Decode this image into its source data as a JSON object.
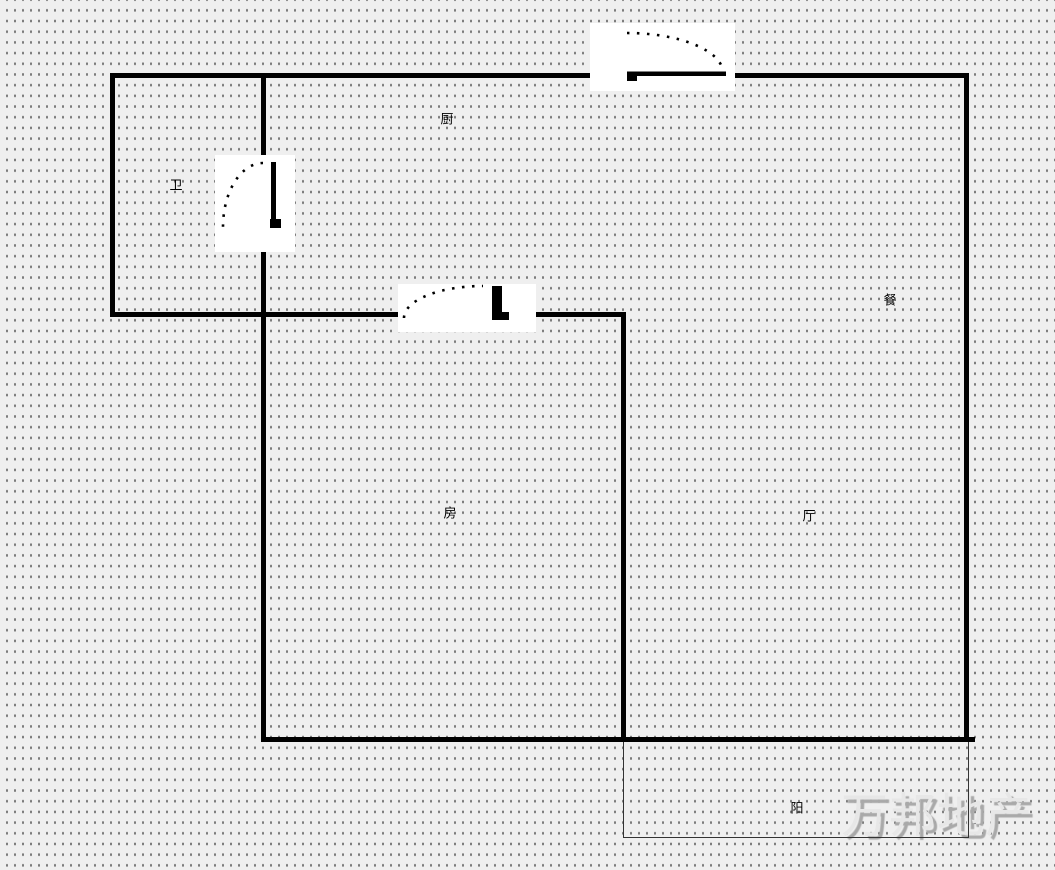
{
  "floorplan": {
    "room_labels": {
      "kitchen": "厨",
      "bathroom": "卫",
      "dining": "餐",
      "bedroom": "房",
      "living_room": "厅",
      "balcony": "阳"
    },
    "watermark_text": "万邦地产",
    "door_icons": [
      {
        "name": "kitchen-door-swing-icon"
      },
      {
        "name": "bathroom-door-swing-icon"
      },
      {
        "name": "bedroom-door-swing-icon"
      }
    ],
    "colors": {
      "wall": "#000000",
      "background": "#efefef",
      "grid_dot": "#7c7c7c",
      "door_symbol": "#000000",
      "balcony_line": "#333333",
      "watermark_fill": "#e7e7e7",
      "watermark_shadow": "#a9a9a9"
    }
  }
}
